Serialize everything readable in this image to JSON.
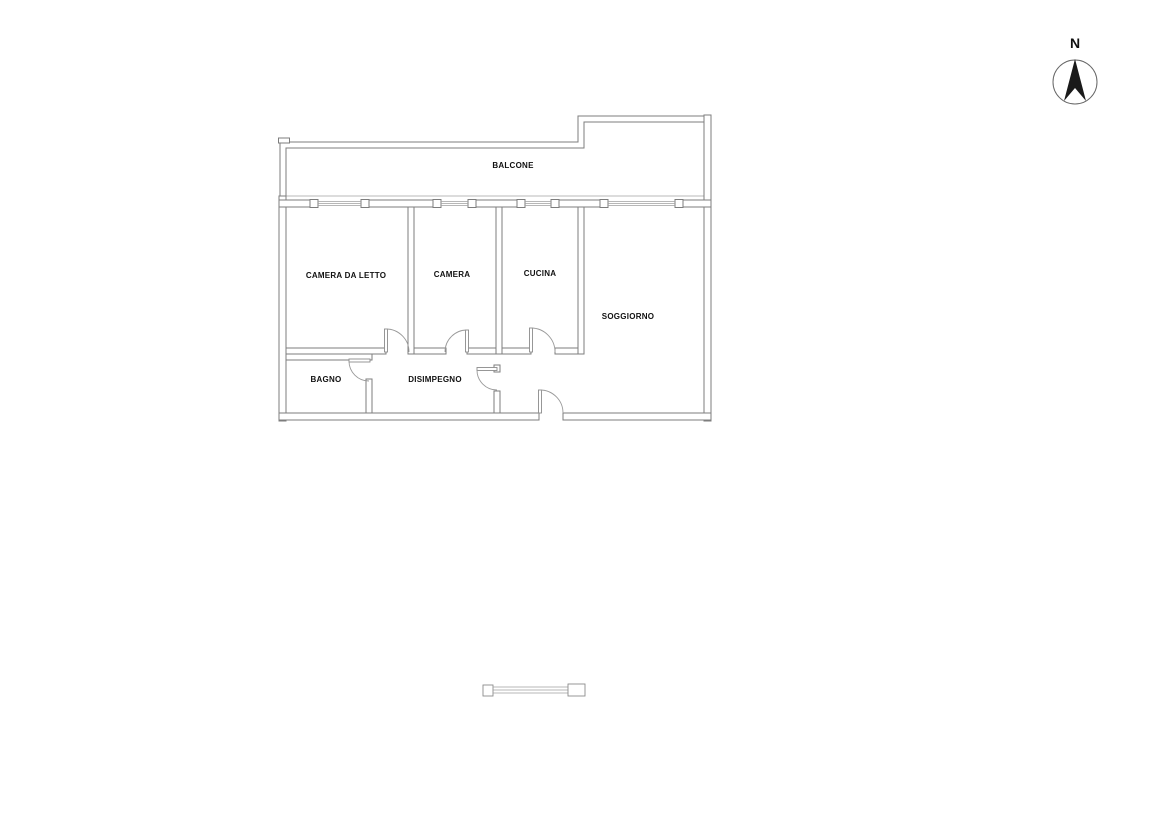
{
  "floor_plan": {
    "room_labels": {
      "balcone": "BALCONE",
      "camera_da_letto": "CAMERA DA LETTO",
      "camera": "CAMERA",
      "cucina": "CUCINA",
      "soggiorno": "SOGGIORNO",
      "bagno": "BAGNO",
      "disimpegno": "DISIMPEGNO"
    },
    "compass": {
      "north_label": "N"
    },
    "colors": {
      "background": "#ffffff",
      "wall_line": "#7d7d7d",
      "thin_line": "#a0a0a0",
      "door_line": "#9a9a9a",
      "label_text": "#111111",
      "compass_needle": "#1a1a1a"
    }
  }
}
